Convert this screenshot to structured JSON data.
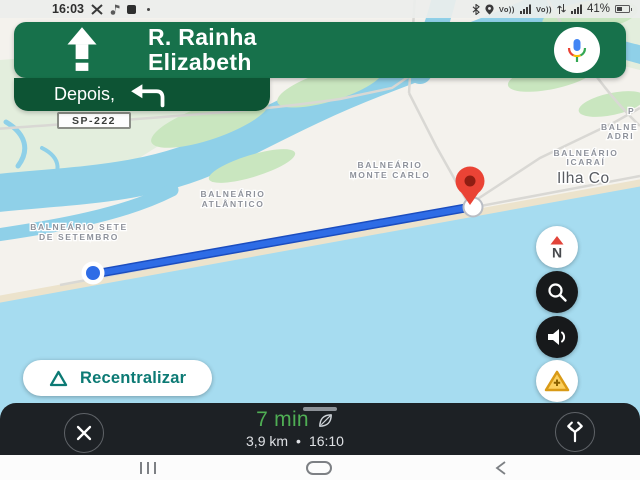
{
  "colors": {
    "banner_green": "#17714b",
    "next_banner_green": "#0d5434",
    "route_blue": "#2e6ce6",
    "eta_green": "#4fae54",
    "accent_teal": "#0c7a74",
    "pin_red": "#ea4335",
    "ocean_blue": "#a6dcf0",
    "sheet_dark": "#1d2125"
  },
  "status_bar": {
    "time": "16:03",
    "volte": "Vo))",
    "battery_percent": "41%"
  },
  "nav_banner": {
    "street_line1": "R. Rainha",
    "street_line2": "Elizabeth"
  },
  "next_banner": {
    "label": "Depois,"
  },
  "map": {
    "shield": "SP-222",
    "city": "Ilha Co",
    "labels": [
      {
        "line1": "BALNEÁRIO",
        "line2": "MONTE CARLO"
      },
      {
        "line1": "BALNEÁRIO",
        "line2": "ICARAÍ"
      },
      {
        "line1": "BALNE",
        "line2": "ADRI"
      },
      {
        "line1": "P",
        "line2": ""
      },
      {
        "line1": "BALNEÁRIO",
        "line2": "ATLÂNTICO"
      },
      {
        "line1": "BALNEÁRIO SETE",
        "line2": "DE SETEMBRO"
      }
    ]
  },
  "map_controls": {
    "compass_letter": "N",
    "recenter_label": "Recentralizar"
  },
  "bottom_bar": {
    "eta": "7 min",
    "distance": "3,9 km",
    "dot": "•",
    "arrival": "16:10"
  }
}
